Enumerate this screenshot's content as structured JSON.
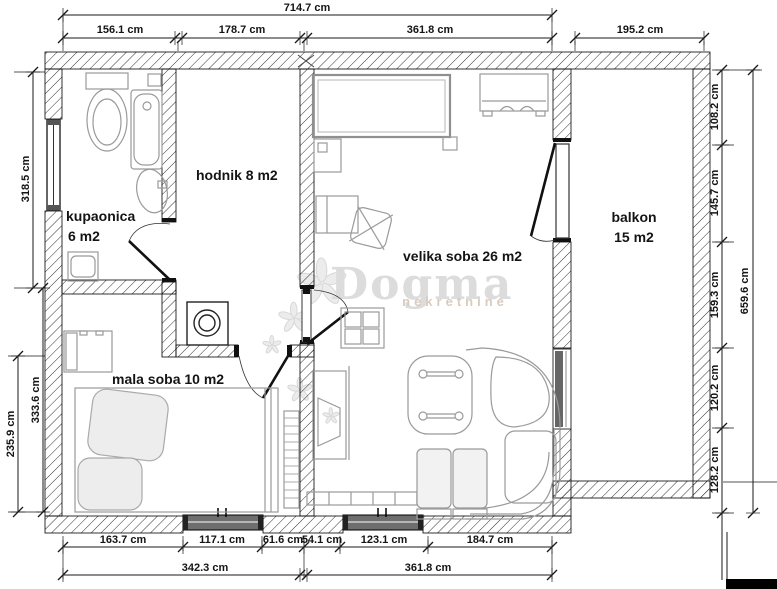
{
  "watermark": {
    "brand": "Dogma",
    "subtitle": "nekretnine"
  },
  "rooms": {
    "kupaonica": {
      "name": "kupaonica",
      "area": "6 m2"
    },
    "hodnik": {
      "label": "hodnik 8 m2"
    },
    "velika_soba": {
      "label": "velika soba 26 m2"
    },
    "mala_soba": {
      "label": "mala soba 10 m2"
    },
    "balkon": {
      "name": "balkon",
      "area": "15 m2"
    }
  },
  "dims": {
    "top": {
      "total": "714.7 cm",
      "segs": [
        "156.1 cm",
        "178.7 cm",
        "361.8 cm"
      ],
      "balcony": "195.2 cm"
    },
    "left": {
      "upper": "318.5 cm",
      "inner": "333.6 cm",
      "outer": "235.9 cm"
    },
    "right": {
      "segs": [
        "108.2 cm",
        "145.7 cm",
        "159.3 cm",
        "120.2 cm",
        "128.2 cm"
      ],
      "total": "659.6 cm"
    },
    "bottom": {
      "segs": [
        "163.7 cm",
        "117.1 cm",
        "61.6 cm",
        "54.1 cm",
        "123.1 cm",
        "184.7 cm"
      ],
      "totals": [
        "342.3 cm",
        "361.8 cm"
      ]
    }
  }
}
